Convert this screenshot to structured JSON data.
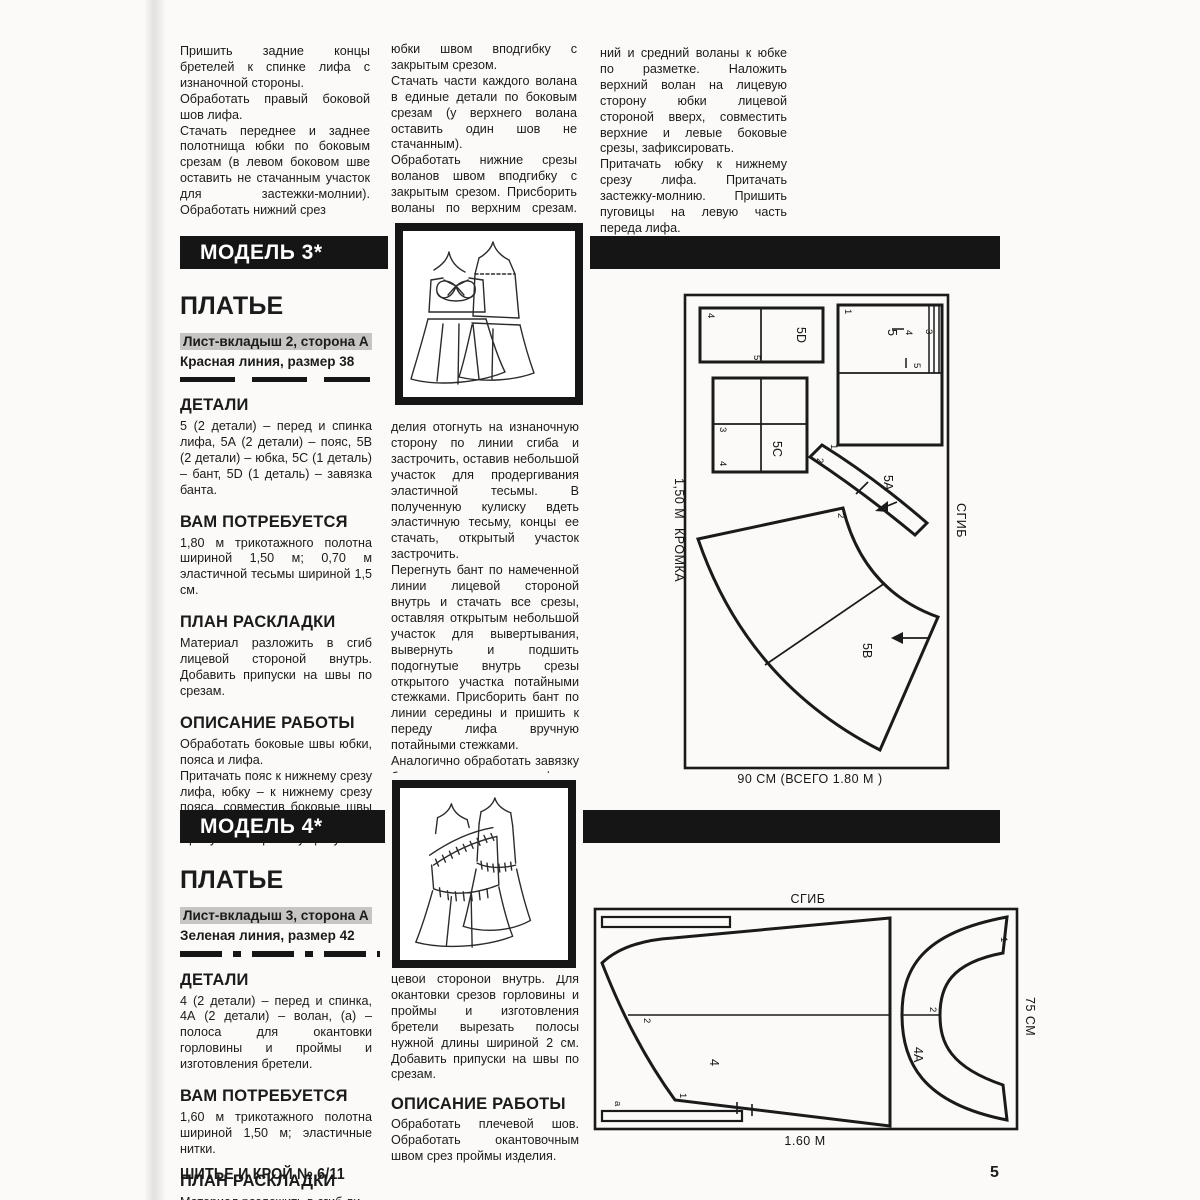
{
  "colors": {
    "banner_bg": "#151515",
    "highlight_bg": "#c6c5c2",
    "ink": "#1b1b1b",
    "paper": "#fbfaf8"
  },
  "top": {
    "col1": {
      "p1": "Пришить задние концы бретелей к спинке лифа с изнаночной стороны.",
      "p2": "Обработать правый боковой шов лифа.",
      "p3": "Стачать переднее и заднее полотнища юбки по боковым срезам (в левом боковом шве оставить не стачанным участок для застежки-молнии). Обработать нижний срез"
    },
    "col2": {
      "p1": "юбки швом вподгибку с закрытым срезом.",
      "p2": "Стачать части каждого волана в единые детали по боковым срезам (у верхнего волана оставить один шов не стачанным).",
      "p3": "Обработать нижние срезы воланов швом вподгибку с закрытым срезом. Присборить воланы по верхним срезам. Притачать ниж-"
    },
    "col3": {
      "p1": "ний и средний воланы к юбке по разметке. Наложить верхний волан на лицевую сторону юбки лицевой стороной вверх, совместить верхние и левые боковые срезы, зафиксировать.",
      "p2": "Притачать юбку к нижнему срезу лифа. Притачать застежку-молнию. Пришить пуговицы на левую часть переда лифа."
    }
  },
  "model3": {
    "banner": "МОДЕЛЬ 3*",
    "title": "ПЛАТЬЕ",
    "sheet": "Лист-вкладыш 2, сторона А",
    "line": "Красная линия, размер 38",
    "details_h": "ДЕТАЛИ",
    "details": "5 (2 детали) – перед и спинка лифа, 5А (2 детали) – пояс, 5В (2 детали) – юбка, 5С (1 деталь) – бант, 5D (1 деталь) – завязка банта.",
    "need_h": "ВАМ ПОТРЕБУЕТСЯ",
    "need": "1,80 м трикотажного полотна шириной 1,50 м; 0,70 м эластичной тесьмы шириной 1,5 см.",
    "plan_h": "ПЛАН РАСКЛАДКИ",
    "plan": "Материал разложить в сгиб лицевой стороной внутрь. Добавить припуски на швы по срезам.",
    "work_h": "ОПИСАНИЕ РАБОТЫ",
    "work1": "Обработать боковые швы юбки, пояса и лифа.",
    "work2": "Притачать пояс к нижнему срезу лифа, юбку – к нижнему срезу пояса, совместив боковые швы деталей.",
    "work3": "Припуск по верхнему срезу из-",
    "col2": {
      "p1": "делия отогнуть на изнаночную сторону по линии сгиба и застрочить, оставив небольшой участок для продергивания эластичной тесьмы. В полученную кулиску вдеть эластичную тесьму, концы ее стачать, открытый участок застрочить.",
      "p2": "Перегнуть бант по намеченной линии лицевой стороной внутрь и стачать все срезы, оставляя открытым небольшой участок для вывертывания, вывернуть и подшить подогнутые внутрь срезы открытого участка потайными стежками. Присборить бант по линии середины и пришить к переду лифа вручную потайными стежками.",
      "p3": "Аналогично обработать завязку банта и пришить ее к лифу по разметке."
    },
    "diagram": {
      "edge1": "1,50 М",
      "edge2": "КРОМКА",
      "fold": "СГИБ",
      "bottom": "90 СМ (ВСЕГО 1.80 М )",
      "p5d": "5D",
      "p5c": "5С",
      "p5": "5",
      "p5a": "5А",
      "p5b": "5В"
    }
  },
  "model4": {
    "banner": "МОДЕЛЬ 4*",
    "title": "ПЛАТЬЕ",
    "sheet": "Лист-вкладыш 3, сторона А",
    "line": "Зеленая линия, размер 42",
    "details_h": "ДЕТАЛИ",
    "details": "4 (2 детали) – перед и спинка, 4А (2 детали) – волан, (а) – полоса для окантовки горловины и проймы и изготовления бретели.",
    "need_h": "ВАМ ПОТРЕБУЕТСЯ",
    "need": "1,60 м трикотажного полотна шириной 1,50 м; эластичные нитки.",
    "plan_h": "ПЛАН РАСКЛАДКИ",
    "plan": "Материал разложить в сгиб ли-",
    "col2": {
      "p1": "цевой стороной внутрь. Для окантовки срезов горловины и проймы и изготовления бретели вырезать полосы нужной длины шириной 2 см. Добавить припуски на швы по срезам.",
      "work_h": "ОПИСАНИЕ РАБОТЫ",
      "work1": "Обработать плечевой шов. Обработать окантовочным швом срез проймы изделия."
    },
    "diagram": {
      "fold": "СГИБ",
      "bottom": "1.60 М",
      "side": "75 СМ",
      "p4": "4",
      "p4a": "4А",
      "pa": "а"
    }
  },
  "marks": {
    "n1": "1",
    "n2": "2",
    "n3": "3",
    "n4": "4",
    "n5": "5"
  },
  "footer": {
    "brand": "ШИТЬЕ И КРОЙ № 6/11",
    "page": "5"
  }
}
